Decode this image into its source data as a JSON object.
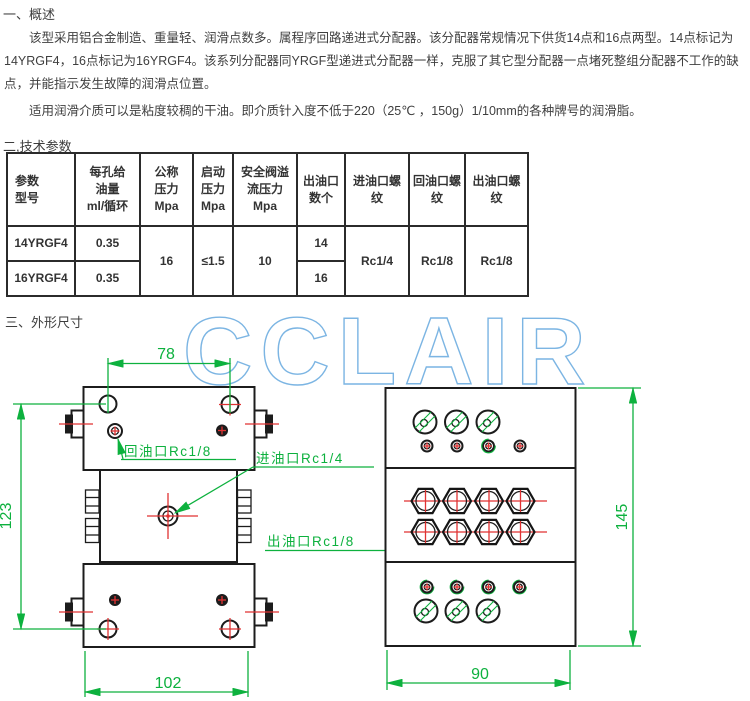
{
  "overview": {
    "heading": "一、概述",
    "para1": "该型采用铝合金制造、重量轻、润滑点数多。属程序回路递进式分配器。该分配器常规情况下供货14点和16点两型。14点标记为14YRGF4，16点标记为16YRGF4。该系列分配器同YRGF型递进式分配器一样，克服了其它型分配器一点堵死整组分配器不工作的缺点，并能指示发生故障的润滑点位置。",
    "para2": "适用润滑介质可以是粘度较稠的干油。即介质针入度不低于220（25℃ ，150g）1/10mm的各种牌号的润滑脂。"
  },
  "tech_params": {
    "heading": "二,技术参数",
    "table": {
      "headers": [
        [
          "参数",
          "型号"
        ],
        [
          "每孔给",
          "油量",
          "ml/循环"
        ],
        [
          "公称",
          "压力",
          "Mpa"
        ],
        [
          "启动",
          "压力",
          "Mpa"
        ],
        [
          "安全阀溢",
          "流压力",
          "Mpa"
        ],
        [
          "出油口",
          "数个"
        ],
        [
          "进油口螺",
          "纹"
        ],
        [
          "回油口螺",
          "纹"
        ],
        [
          "出油口螺",
          "纹"
        ]
      ],
      "row1": {
        "model": "14YRGF4",
        "oil_per_hole": "0.35",
        "outlet_count": "14"
      },
      "row2": {
        "model": "16YRGF4",
        "oil_per_hole": "0.35",
        "outlet_count": "16"
      },
      "shared": {
        "nominal_pressure": "16",
        "start_pressure": "≤1.5",
        "relief_pressure": "10",
        "inlet_thread": "Rc1/4",
        "return_thread": "Rc1/8",
        "outlet_thread": "Rc1/8"
      }
    }
  },
  "drawing": {
    "heading": "三、外形尺寸",
    "watermark": "CCLAIR",
    "dims": {
      "hole_spacing": "78",
      "left_height": "123",
      "left_width": "102",
      "right_height": "145",
      "right_width": "90"
    },
    "port_labels": {
      "return": "回油口Rc1/8",
      "inlet": "进油口Rc1/4",
      "outlet": "出油口Rc1/8"
    }
  },
  "colors": {
    "dimension_green": "#0db13e",
    "crosshair_red": "#e03232",
    "watermark_blue": "#7cb5e3",
    "line_black": "#1c1c1c"
  }
}
